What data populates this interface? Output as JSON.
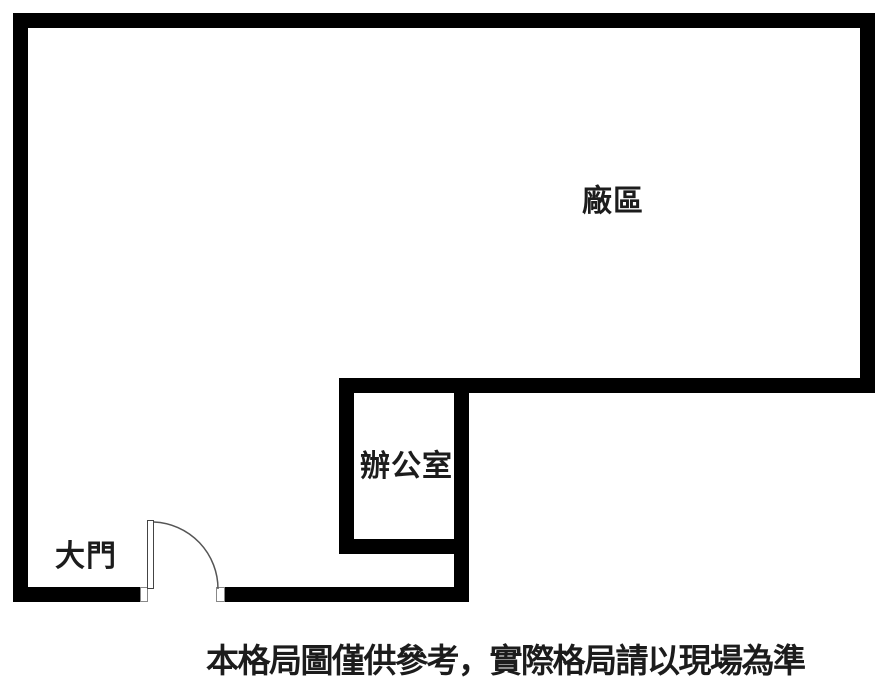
{
  "floorplan": {
    "labels": {
      "factory": "廠區",
      "office": "辦公室",
      "gate": "大門"
    },
    "caption": "本格局圖僅供參考，實際格局請以現場為準",
    "colors": {
      "wall": "#000000",
      "background": "#ffffff",
      "text": "#1c1c1c",
      "door_line": "#555555"
    }
  }
}
